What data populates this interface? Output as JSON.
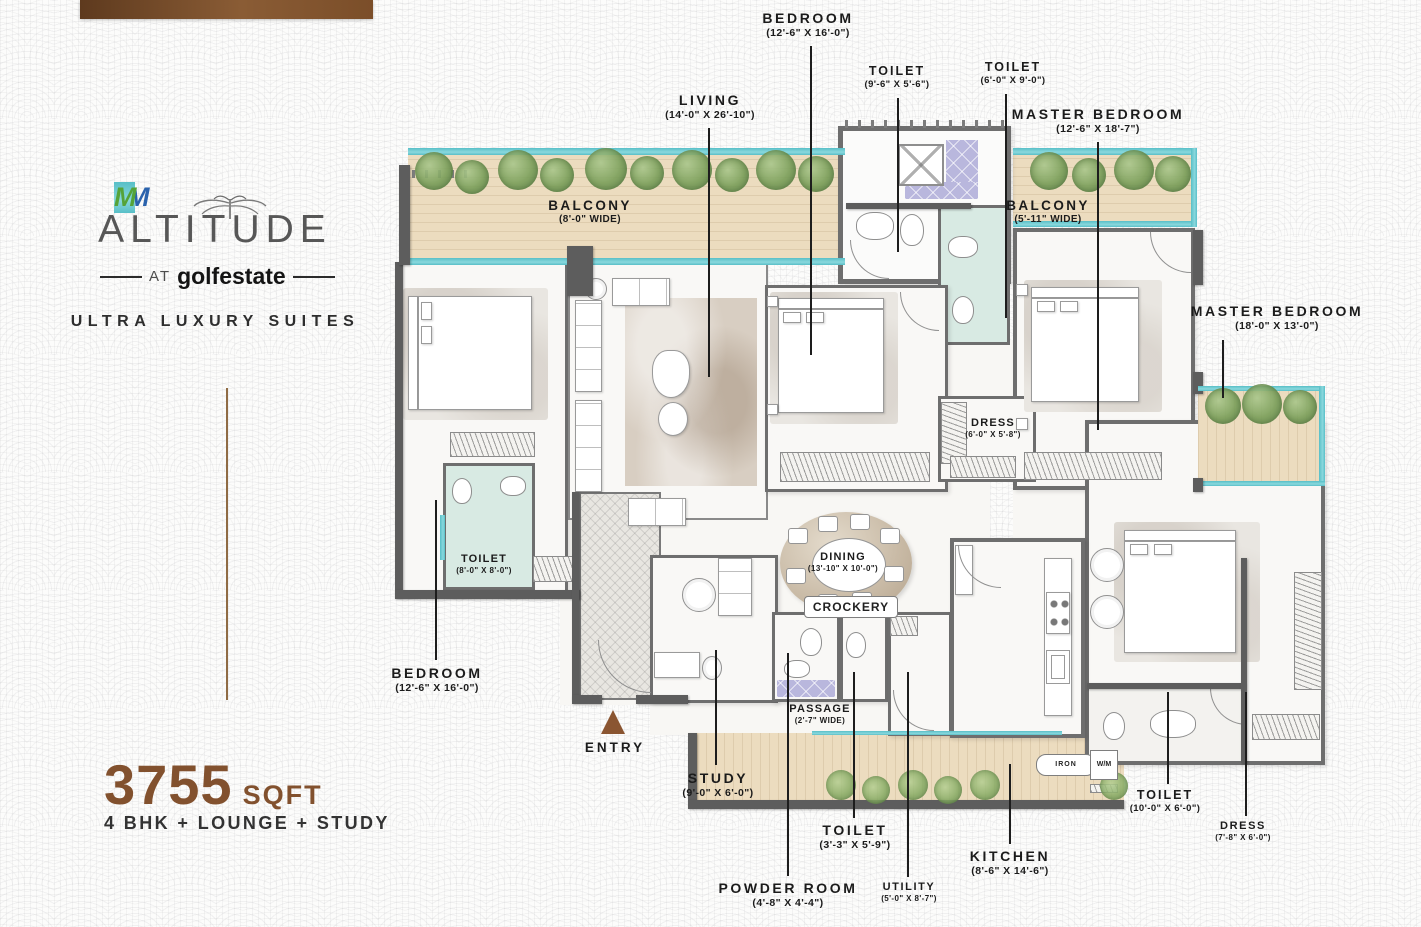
{
  "branding": {
    "logo_m1": "M",
    "logo_3": "3",
    "logo_m2": "M",
    "project": "ALTITUDE",
    "at": "AT",
    "estate": "golfestate",
    "subtitle": "ULTRA LUXURY SUITES"
  },
  "area": {
    "size": "3755",
    "unit": "SQFT",
    "configuration": "4 BHK + LOUNGE + STUDY"
  },
  "entry_label": "ENTRY",
  "tags": {
    "crockery": "CROCKERY",
    "iron": "IRON",
    "wm": "W/M"
  },
  "colors": {
    "accent_brown": "#82512e",
    "wall_gray": "#5d5d5d",
    "glass_teal": "#58bfc7",
    "balcony_wood": "#ecdcbf",
    "toilet_floor": "#d8eae3",
    "shower_tile": "#b9b7dd",
    "plant_green": "#7ba05b",
    "brand_green": "#55a339",
    "brand_blue": "#2b63ad"
  },
  "plan": {
    "labels": [
      {
        "id": "bedroom-top",
        "name": "BEDROOM",
        "dims": "(12'-6\" X 16'-0\")",
        "x": 808,
        "y": 10,
        "size": "",
        "leader": {
          "x": 810,
          "y1": 46,
          "y2": 355
        }
      },
      {
        "id": "living",
        "name": "LIVING",
        "dims": "(14'-0\" X 26'-10\")",
        "x": 710,
        "y": 92,
        "size": "",
        "leader": {
          "x": 708,
          "y1": 128,
          "y2": 377
        }
      },
      {
        "id": "toilet-top",
        "name": "TOILET",
        "dims": "(9'-6\" X 5'-6\")",
        "x": 897,
        "y": 64,
        "size": "md",
        "leader": {
          "x": 897,
          "y1": 98,
          "y2": 252
        }
      },
      {
        "id": "toilet-top-2",
        "name": "TOILET",
        "dims": "(6'-0\" X 9'-0\")",
        "x": 1013,
        "y": 60,
        "size": "md",
        "leader": {
          "x": 1005,
          "y1": 94,
          "y2": 318
        }
      },
      {
        "id": "master-bedroom-1",
        "name": "MASTER BEDROOM",
        "dims": "(12'-6\" X 18'-7\")",
        "x": 1098,
        "y": 106,
        "size": "",
        "leader": {
          "x": 1097,
          "y1": 142,
          "y2": 430
        }
      },
      {
        "id": "master-bedroom-2",
        "name": "MASTER BEDROOM",
        "dims": "(18'-0\" X 13'-0\")",
        "x": 1277,
        "y": 303,
        "size": "",
        "leader": {
          "x": 1222,
          "y1": 340,
          "y2": 398
        }
      },
      {
        "id": "bedroom-left",
        "name": "BEDROOM",
        "dims": "(12'-6\" X 16'-0\")",
        "x": 437,
        "y": 665,
        "size": "",
        "leader": {
          "x": 435,
          "y1": 500,
          "y2": 660
        }
      },
      {
        "id": "study",
        "name": "STUDY",
        "dims": "(9'-0\" X 6'-0\")",
        "x": 718,
        "y": 770,
        "size": "",
        "leader": {
          "x": 715,
          "y1": 650,
          "y2": 765
        }
      },
      {
        "id": "toilet-bottom",
        "name": "TOILET",
        "dims": "(3'-3\" X 5'-9\")",
        "x": 855,
        "y": 822,
        "size": "",
        "leader": {
          "x": 853,
          "y1": 672,
          "y2": 818
        }
      },
      {
        "id": "powder-room",
        "name": "POWDER ROOM",
        "dims": "(4'-8\" X 4'-4\")",
        "x": 788,
        "y": 880,
        "size": "",
        "leader": {
          "x": 787,
          "y1": 653,
          "y2": 876
        }
      },
      {
        "id": "utility",
        "name": "UTILITY",
        "dims": "(5'-0\" X 8'-7\")",
        "x": 909,
        "y": 881,
        "size": "sm",
        "leader": {
          "x": 907,
          "y1": 672,
          "y2": 877
        }
      },
      {
        "id": "kitchen",
        "name": "KITCHEN",
        "dims": "(8'-6\" X 14'-6\")",
        "x": 1010,
        "y": 848,
        "size": "",
        "leader": {
          "x": 1009,
          "y1": 764,
          "y2": 844
        }
      },
      {
        "id": "toilet-bottom-right",
        "name": "TOILET",
        "dims": "(10'-0\" X 6'-0\")",
        "x": 1165,
        "y": 788,
        "size": "md",
        "leader": {
          "x": 1167,
          "y1": 692,
          "y2": 784
        }
      },
      {
        "id": "dress-2",
        "name": "DRESS",
        "dims": "(7'-8\" X 6'-0\")",
        "x": 1243,
        "y": 820,
        "size": "sm",
        "leader": {
          "x": 1245,
          "y1": 692,
          "y2": 816
        }
      },
      {
        "id": "balcony-left",
        "name": "BALCONY",
        "dims": "(8'-0\" WIDE)",
        "x": 590,
        "y": 198,
        "size": "in-md"
      },
      {
        "id": "balcony-right",
        "name": "BALCONY",
        "dims": "(5'-11\" WIDE)",
        "x": 1048,
        "y": 198,
        "size": "in-md"
      },
      {
        "id": "toilet-left",
        "name": "TOILET",
        "dims": "(8'-0\" X 8'-0\")",
        "x": 484,
        "y": 553,
        "size": "in-sm"
      },
      {
        "id": "dress-1",
        "name": "DRESS",
        "dims": "(6'-0\" X 5'-8\")",
        "x": 993,
        "y": 417,
        "size": "in-sm"
      },
      {
        "id": "dining",
        "name": "DINING",
        "dims": "(13'-10\" X 10'-0\")",
        "x": 843,
        "y": 551,
        "size": "in-sm"
      },
      {
        "id": "passage",
        "name": "PASSAGE",
        "dims": "(2'-7\" WIDE)",
        "x": 820,
        "y": 703,
        "size": "in-sm"
      }
    ]
  }
}
